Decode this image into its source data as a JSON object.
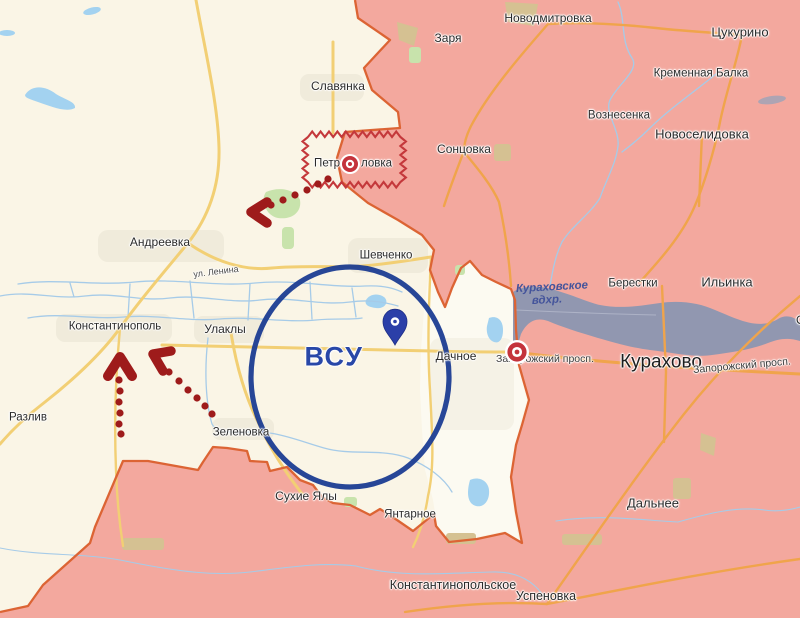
{
  "map": {
    "colors": {
      "base": "#FAF5E6",
      "occupied": "#F3A89E",
      "frontline": "#DC6434",
      "pocket": "#FCFAF1",
      "river": "#A6CBE8",
      "lake": "#A3D2F0",
      "reservoir": "#9197B0",
      "road_primary": "#F2CF74",
      "road_secondary": "#F0A44B",
      "arrow": "#9E1B1B",
      "zigzag": "#C4383B",
      "target": "#C4333C",
      "ellipse": "#1B3C92",
      "pin": "#2B3FA8",
      "label": "#2B2B2B",
      "water_label": "#44549B",
      "unit_label": "#2847A8"
    },
    "labels": [
      {
        "text": "Славянка",
        "x": 338,
        "y": 86,
        "size": 12
      },
      {
        "text": "Заря",
        "x": 448,
        "y": 38,
        "size": 12
      },
      {
        "text": "Новодмитровка",
        "x": 548,
        "y": 18,
        "size": 12
      },
      {
        "text": "Цукурино",
        "x": 740,
        "y": 32,
        "size": 13
      },
      {
        "text": "Кременная Балка",
        "x": 701,
        "y": 74,
        "size": 11.5
      },
      {
        "text": "Вознесенка",
        "x": 619,
        "y": 116,
        "size": 11.5
      },
      {
        "text": "Новоселидовка",
        "x": 702,
        "y": 134,
        "size": 13
      },
      {
        "text": "Сонцовка",
        "x": 464,
        "y": 149,
        "size": 12
      },
      {
        "text": "Петр",
        "x": 340,
        "y": 164,
        "size": 11.5,
        "align": "right",
        "name": "partial-town-label"
      },
      {
        "text": "ловка",
        "x": 361,
        "y": 164,
        "size": 11.5,
        "align": "left",
        "name": "partial-town-label"
      },
      {
        "text": "Шевченко",
        "x": 386,
        "y": 256,
        "size": 11.5
      },
      {
        "text": "Андреевка",
        "x": 160,
        "y": 242,
        "size": 12
      },
      {
        "text": "ул. Ленина",
        "x": 216,
        "y": 272,
        "size": 9,
        "rot": -7,
        "color": "#4a4a4a",
        "name": "street-label"
      },
      {
        "text": "Константинополь",
        "x": 115,
        "y": 327,
        "size": 11.5
      },
      {
        "text": "Улаклы",
        "x": 225,
        "y": 329,
        "size": 12
      },
      {
        "text": "Кураховское",
        "x": 552,
        "y": 288,
        "size": 11.5,
        "italic": true,
        "weight": 600,
        "rot": -3,
        "color": "#44549B",
        "cls": "water",
        "name": "water-label"
      },
      {
        "text": "вдхр.",
        "x": 547,
        "y": 301,
        "size": 11.5,
        "italic": true,
        "weight": 600,
        "rot": -3,
        "color": "#44549B",
        "cls": "water",
        "name": "water-label"
      },
      {
        "text": "Берестки",
        "x": 633,
        "y": 284,
        "size": 11.5
      },
      {
        "text": "Ильинка",
        "x": 727,
        "y": 282,
        "size": 13
      },
      {
        "text": "Ос",
        "x": 796,
        "y": 320,
        "size": 12,
        "align": "left",
        "name": "clipped-town-label"
      },
      {
        "text": "Дачное",
        "x": 456,
        "y": 356,
        "size": 12
      },
      {
        "text": "Запорожский просп.",
        "x": 545,
        "y": 359,
        "size": 10.5,
        "color": "#3b3b3b",
        "name": "street-label"
      },
      {
        "text": "Курахово",
        "x": 661,
        "y": 362,
        "size": 19,
        "weight": 500,
        "color": "#1e1e1e",
        "name": "city-label"
      },
      {
        "text": "Запорожский просп.",
        "x": 742,
        "y": 366,
        "size": 10.5,
        "rot": -5,
        "color": "#3b3b3b",
        "name": "street-label"
      },
      {
        "text": "ВСУ",
        "x": 334,
        "y": 357,
        "size": 27,
        "weight": 600,
        "color": "#2847A8",
        "spacing": 1.5,
        "name": "unit-label"
      },
      {
        "text": "Разлив",
        "x": 28,
        "y": 418,
        "size": 11.5
      },
      {
        "text": "Зеленовка",
        "x": 241,
        "y": 433,
        "size": 11.5
      },
      {
        "text": "Сухие Ялы",
        "x": 306,
        "y": 496,
        "size": 12
      },
      {
        "text": "Янтарное",
        "x": 410,
        "y": 515,
        "size": 11.5
      },
      {
        "text": "Дальнее",
        "x": 653,
        "y": 503,
        "size": 13
      },
      {
        "text": "Константинопольское",
        "x": 453,
        "y": 585,
        "size": 12.5
      },
      {
        "text": "Успеновка",
        "x": 546,
        "y": 596,
        "size": 12.5
      }
    ],
    "markers": {
      "targets": [
        {
          "x": 350,
          "y": 164,
          "r": 10
        },
        {
          "x": 517,
          "y": 352,
          "r": 12
        }
      ],
      "pin": {
        "x": 395,
        "y": 323
      },
      "encirclement": {
        "cx": 350,
        "cy": 377,
        "rx": 99,
        "ry": 110,
        "label": "ВСУ"
      }
    },
    "icons": [
      "strike-target-icon",
      "location-pin-icon",
      "advance-arrow-icon",
      "contested-area-zigzag",
      "encirclement-ellipse"
    ]
  }
}
